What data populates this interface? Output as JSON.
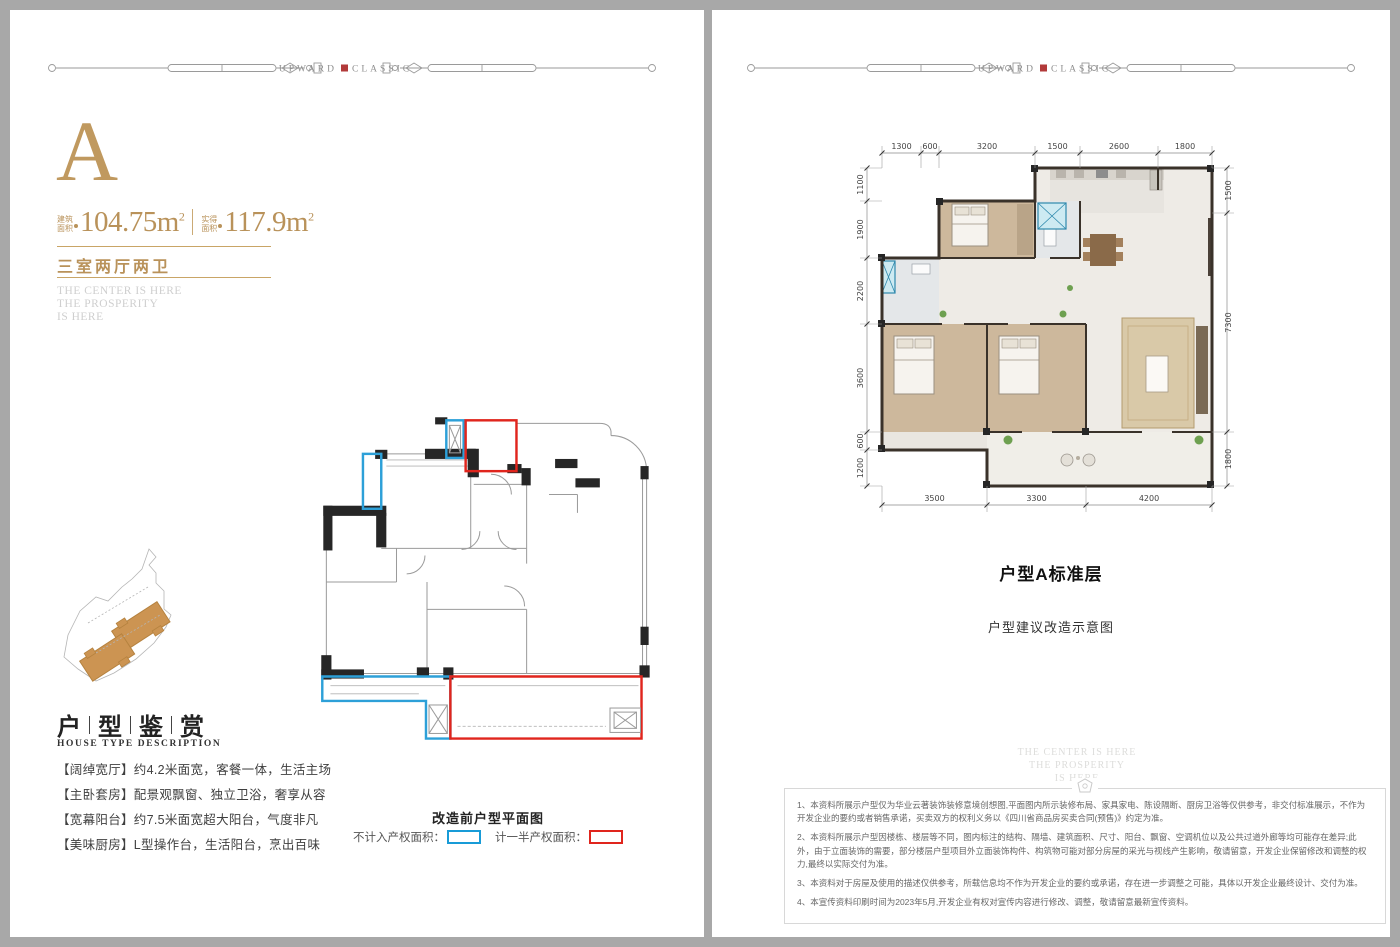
{
  "brand": {
    "word_left": "UPWARD",
    "word_right": "CLASSIC",
    "accent_color": "#b23a3a"
  },
  "page_left": {
    "unit_letter": "A",
    "areas": [
      {
        "label_top": "建筑",
        "label_bottom": "面积",
        "value": "104.75",
        "unit": "m",
        "sup": "2"
      },
      {
        "label_top": "实得",
        "label_bottom": "面积",
        "value": "117.9",
        "unit": "m",
        "sup": "2"
      }
    ],
    "layout_type": "三室两厅两卫",
    "taglines": [
      "THE CENTER IS HERE",
      "THE PROSPERITY",
      "IS HERE"
    ],
    "section_title_chars": [
      "户",
      "型",
      "鉴",
      "赏"
    ],
    "section_subtitle": "HOUSE TYPE DESCRIPTION",
    "features": [
      "【阔绰宽厅】约4.2米面宽，客餐一体，生活主场",
      "【主卧套房】配景观飘窗、独立卫浴，奢享从容",
      "【宽幕阳台】约7.5米面宽超大阳台，气度非凡",
      "【美味厨房】L型操作台，生活阳台，烹出百味"
    ],
    "plan_caption": "改造前户型平面图",
    "legend": [
      {
        "label": "不计入产权面积：",
        "color": "#189bd7"
      },
      {
        "label": "计一半产权面积：",
        "color": "#e0251d"
      }
    ]
  },
  "page_right": {
    "floor_plan": {
      "title": "户型A标准层",
      "subtitle": "户型建议改造示意图",
      "dimensions_mm": {
        "top": [
          1300,
          600,
          3200,
          1500,
          2600,
          1800
        ],
        "left": [
          1100,
          1900,
          2200,
          3600,
          600,
          1200
        ],
        "right": [
          1500,
          7300,
          1800
        ],
        "bottom": [
          3500,
          3300,
          4200
        ]
      }
    },
    "watermark": [
      "THE CENTER IS HERE",
      "THE PROSPERITY",
      "IS HERE"
    ],
    "disclaimers": [
      "1、本资料所展示户型仅为华业云著装饰装修意境创想图,平面图内所示装修布局、家具家电、陈设隔断、厨房卫浴等仅供参考，非交付标准展示，不作为开发企业的要约或者销售承诺，买卖双方的权利义务以《四川省商品房买卖合同(预售)》约定为准。",
      "2、本资料所展示户型因楼栋、楼层等不同，图内标注的结构、隔墙、建筑面积、尺寸、阳台、飘窗、空调机位以及公共过道外廊等均可能存在差异;此外，由于立面装饰的需要，部分楼层户型项目外立面装饰构件、构筑物可能对部分房屋的采光与视线产生影响，敬请留意，开发企业保留修改和调整的权力,最终以实际交付为准。",
      "3、本资料对于房屋及使用的描述仅供参考，所载信息均不作为开发企业的要约或承诺，存在进一步调整之可能，具体以开发企业最终设计、交付为准。",
      "4、本宣传资料印刷时间为2023年5月,开发企业有权对宣传内容进行修改、调整，敬请留意最新宣传资料。"
    ]
  },
  "colors": {
    "gold": "#bf9960",
    "gold_line": "#c9a566",
    "wall": "#3a322a",
    "wood_floor": "#cdb89c",
    "marble_floor": "#eeebe6",
    "legend_blue": "#189bd7",
    "legend_red": "#e0251d"
  }
}
